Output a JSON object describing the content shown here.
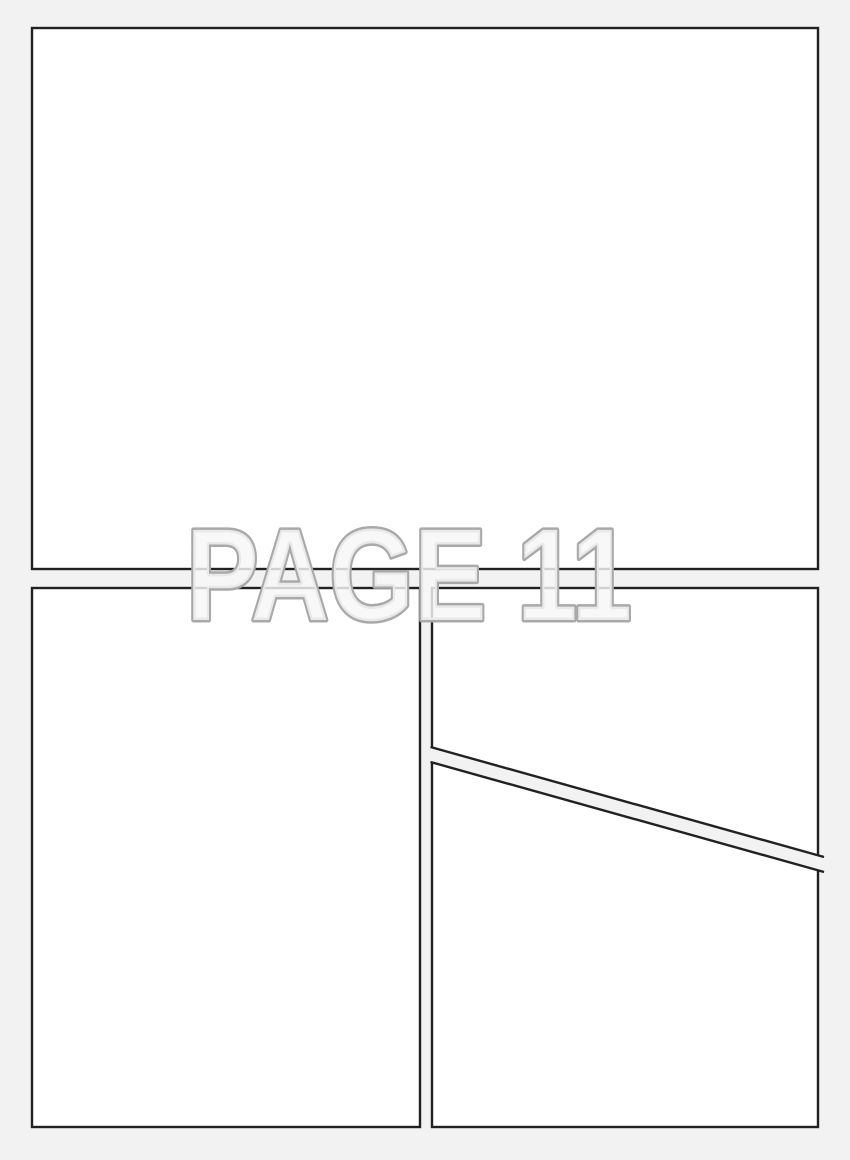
{
  "page": {
    "watermark_label": "PAGE 11"
  },
  "colors": {
    "background": "#f2f2f2",
    "panel_fill": "#ffffff",
    "panel_border": "#212121",
    "gutter_fill": "#f2f2f2",
    "watermark_fill": "rgba(246,246,246,0.82)",
    "watermark_outline": "#a9a9a9"
  }
}
